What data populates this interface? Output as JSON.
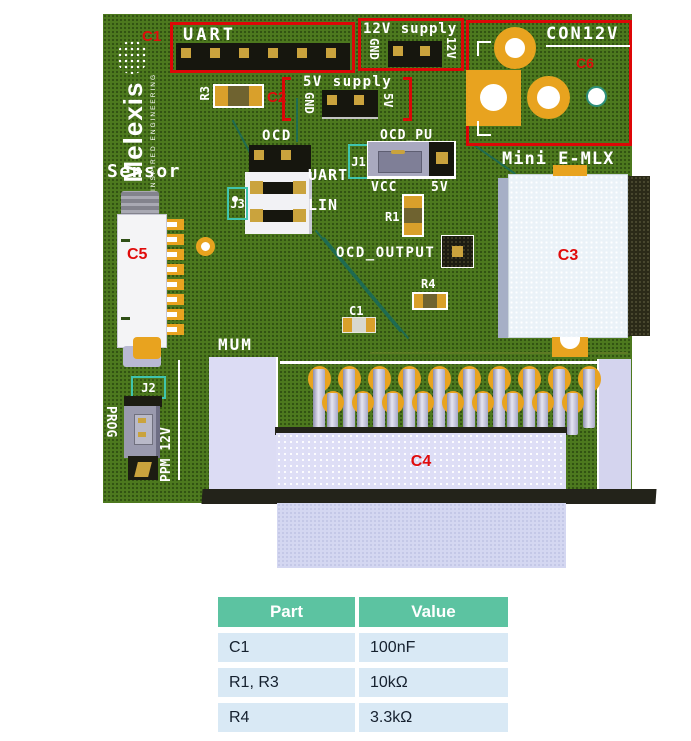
{
  "logo": {
    "brand": "Melexis",
    "tagline": "INSPIRED ENGINEERING"
  },
  "callouts": {
    "c1": "C1",
    "c2": "C2",
    "c3": "C3",
    "c4": "C4",
    "c5": "C5",
    "c6": "C6"
  },
  "refs": {
    "r1": "R1",
    "r3": "R3",
    "r4": "R4",
    "c1cap": "C1",
    "j1": "J1",
    "j2": "J2",
    "j3": "J3"
  },
  "silk": {
    "uart_top": "UART",
    "supply12": "12V supply",
    "gnd12": "GND",
    "v12": "12V",
    "con12v": "CON12V",
    "supply5": "5V supply",
    "gnd5": "GND",
    "v5": "5V",
    "ocd": "OCD",
    "ocd_pu": "OCD_PU",
    "uart_j3": "UART",
    "lin": "LIN",
    "vcc": "VCC",
    "v5_j1": "5V",
    "sensor": "Sensor",
    "mini_emlx": "Mini E-MLX",
    "ocd_output": "OCD_OUTPUT",
    "mum": "MUM",
    "prog": "PROG",
    "ppm12v": "PPM 12V"
  },
  "table": {
    "headers": [
      "Part",
      "Value"
    ],
    "rows": [
      [
        "C1",
        "100nF"
      ],
      [
        "R1, R3",
        "10kΩ"
      ],
      [
        "R4",
        "3.3kΩ"
      ]
    ]
  },
  "colors": {
    "board_green": "#4d791e",
    "annotation_red": "#dd0707",
    "teal": "#3fc4ae",
    "gold": "#e8a31f",
    "table_header": "#5cc3a1",
    "table_row": "#d9e9f5"
  }
}
